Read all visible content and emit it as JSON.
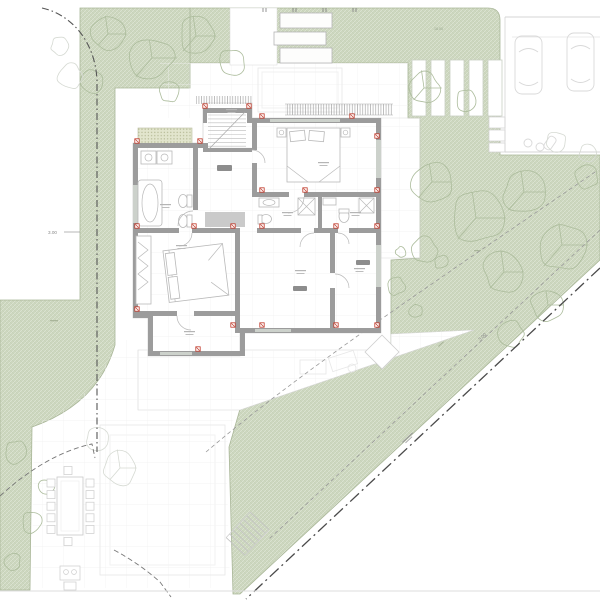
{
  "drawing": {
    "kind_label": "architectural site plan with ground floor plan",
    "annotations": {
      "dim_left": "3.00",
      "dim_diagonal": "3.00",
      "dim_top": "18.00"
    },
    "colors": {
      "site_green": "#cdd7bf",
      "green_edge": "#a9b698",
      "wall_gray": "#9c9c9c",
      "marker_red": "#c03a2b",
      "boundary_dark": "#4a4a4a",
      "plan_line_light": "#c8c8c8",
      "tree_on_green": "#acbc9c",
      "tree_on_white": "#d6dad3"
    }
  }
}
